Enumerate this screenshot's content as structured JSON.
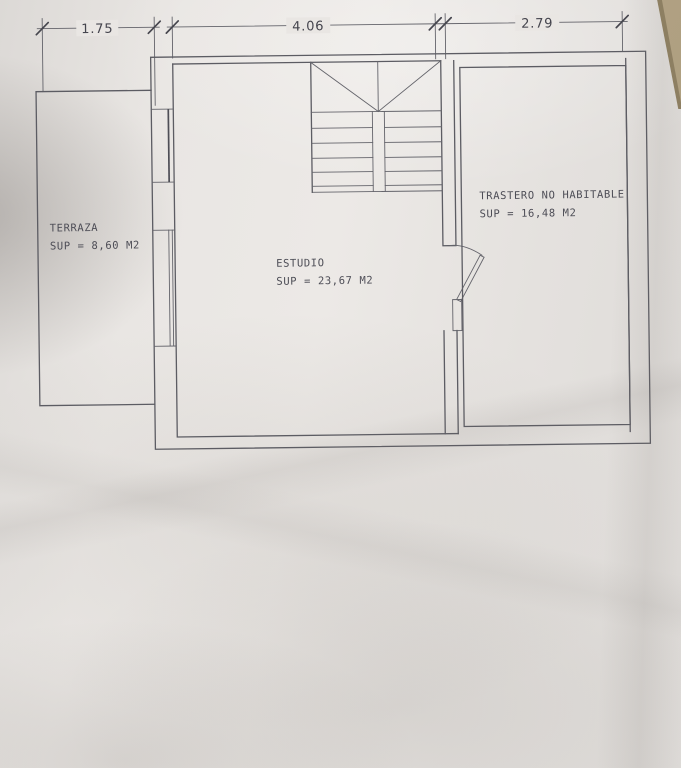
{
  "photo": {
    "description": "Photograph of an architectural floor plan drawing on paper",
    "paper_color": "#e9e6e3",
    "line_color": "#5c5c63",
    "text_color": "#4d4d56",
    "table_color": "#a99a7b"
  },
  "dims": {
    "d1": "1.75",
    "d2": "4.06",
    "d3": "2.79"
  },
  "rooms": {
    "terraza": {
      "name": "TERRAZA",
      "area": "SUP = 8,60 M2"
    },
    "estudio": {
      "name": "ESTUDIO",
      "area": "SUP = 23,67 M2"
    },
    "trastero": {
      "name": "TRASTERO NO HABITABLE",
      "area": "SUP = 16,48 M2"
    }
  }
}
